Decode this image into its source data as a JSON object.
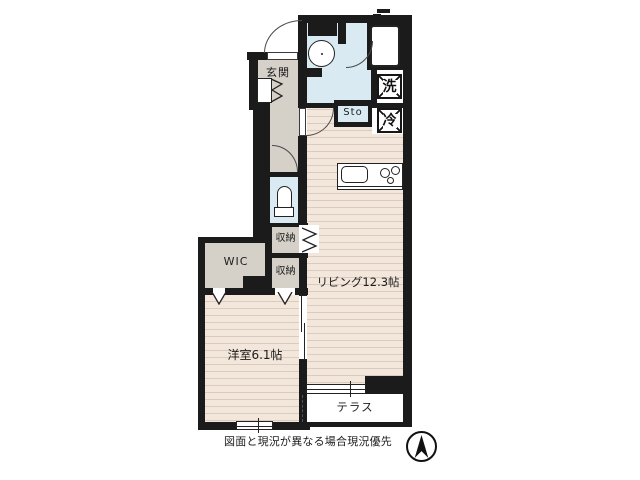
{
  "floorplan": {
    "caption": "図面と現況が異なる場合現況優先",
    "rooms": {
      "genkan": "玄関",
      "living": "リビング12.3帖",
      "bedroom": "洋室6.1帖",
      "terrace": "テラス",
      "wic": "WIC",
      "storage_upper": "収納",
      "storage_lower": "収納",
      "sto": "Sto",
      "washer": "洗",
      "fridge": "冷"
    },
    "compass_icon": "north-arrow",
    "colors": {
      "wall": "#1b1b1b",
      "water": "#d9eaf2",
      "hall": "#d5d1c9",
      "floor": "#f3e6db",
      "stripe": "#d9cbbf"
    }
  }
}
